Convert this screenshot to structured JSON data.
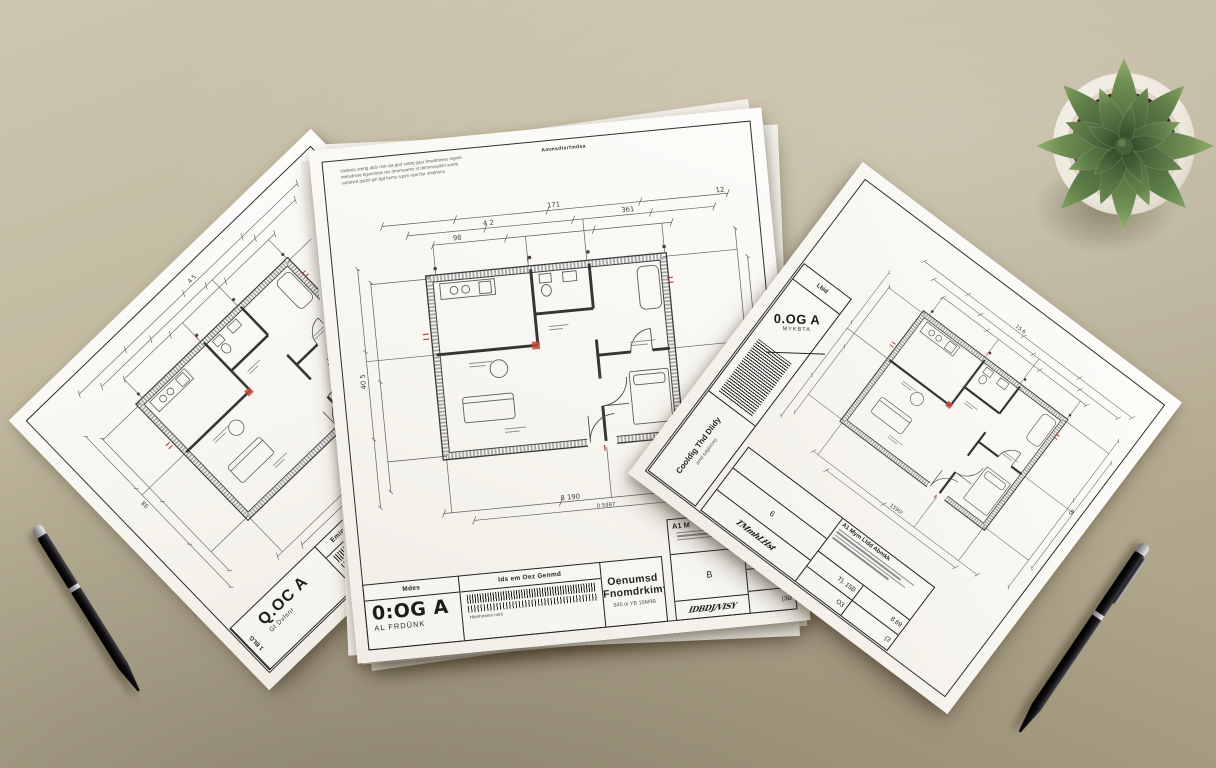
{
  "scene": {
    "description": "Top-down photo of three architectural floor-plan blueprints on a beige desk with two black pens and a potted succulent",
    "desk_color": "#c0b79e",
    "paper_color": "#f9f7f2",
    "accent_red": "#b43a2a",
    "line_color": "#3c3c3c"
  },
  "sheet_left": {
    "title_header": "Emind Ghnn Zmnd Thkbem",
    "big_label": "Q.OC A",
    "big_sub": "Gl Dvlsnr",
    "side_label": "1 BLG",
    "barcode_note": "Hmnbsmm",
    "dims": {
      "d1": "4 5",
      "d2": "98",
      "d3": "1 8"
    }
  },
  "sheet_center": {
    "notes": [
      "Hmbnts smrtg atds mst sta gnd sntmj gqsr fmwdnmies mgmb",
      "nmtsdmse bgwsmms ms dmrmswms sf dnmmsqsbm smnb",
      "ssmmsd qsdsf gm tgd bsms sqsm sbw bsr smdmms"
    ],
    "notes_bold": "Ammsdtsrfmdsa",
    "dims": {
      "top": "171",
      "top_right": "12",
      "t2": "4 2",
      "t3": "361",
      "t4": "98",
      "left": "40 5",
      "right": "57 36",
      "bottom": "8 190",
      "bottom_small": "0 5987"
    },
    "title_block": {
      "col1_header": "Mdes",
      "big_label": "0:OG A",
      "big_sub": "AL FRDÜNK",
      "col2_header": "Ids em Oez Genmd",
      "col2_note": "Hbmhmmm mml",
      "col3_title": "Oenumsd Fnomdrkimy",
      "col3_sub": "845 oi YB 15M9B",
      "mini_header": "A1 M",
      "row_b": "B",
      "row_tk": "Tk 15A",
      "row_869": "8 69",
      "row_o": "(3Ø",
      "signature": "IDBDJ/VISY"
    }
  },
  "sheet_right": {
    "strip_top": "Lbid",
    "big_label": "0.OG A",
    "big_sub": "MYKBTA",
    "mid_title": "Cooldig Thd Dlidy",
    "mid_sub": "amd sdgbmwy",
    "para_header": "A1 Mym Lldd Abmkk",
    "cell_6": "6",
    "cell_t15": "T). 15B",
    "cell_869": "8 69",
    "cell_o3": "O3",
    "cell_b3": "(3",
    "signature": "TMmhLHst",
    "dims": {
      "d1": "1590!",
      "d2": "45",
      "d3": "15 6"
    }
  },
  "objects": {
    "plant": {
      "label": "succulent in white pot",
      "pot_color": "#f2efe9",
      "soil_color": "#3c2a1b",
      "leaf_color": "#5d7b45"
    },
    "pen_left": {
      "label": "black ballpoint pen",
      "body_color": "#121214",
      "trim_color": "#c9c9cc"
    },
    "pen_right": {
      "label": "black ballpoint pen",
      "body_color": "#121214",
      "trim_color": "#c9c9cc"
    }
  }
}
